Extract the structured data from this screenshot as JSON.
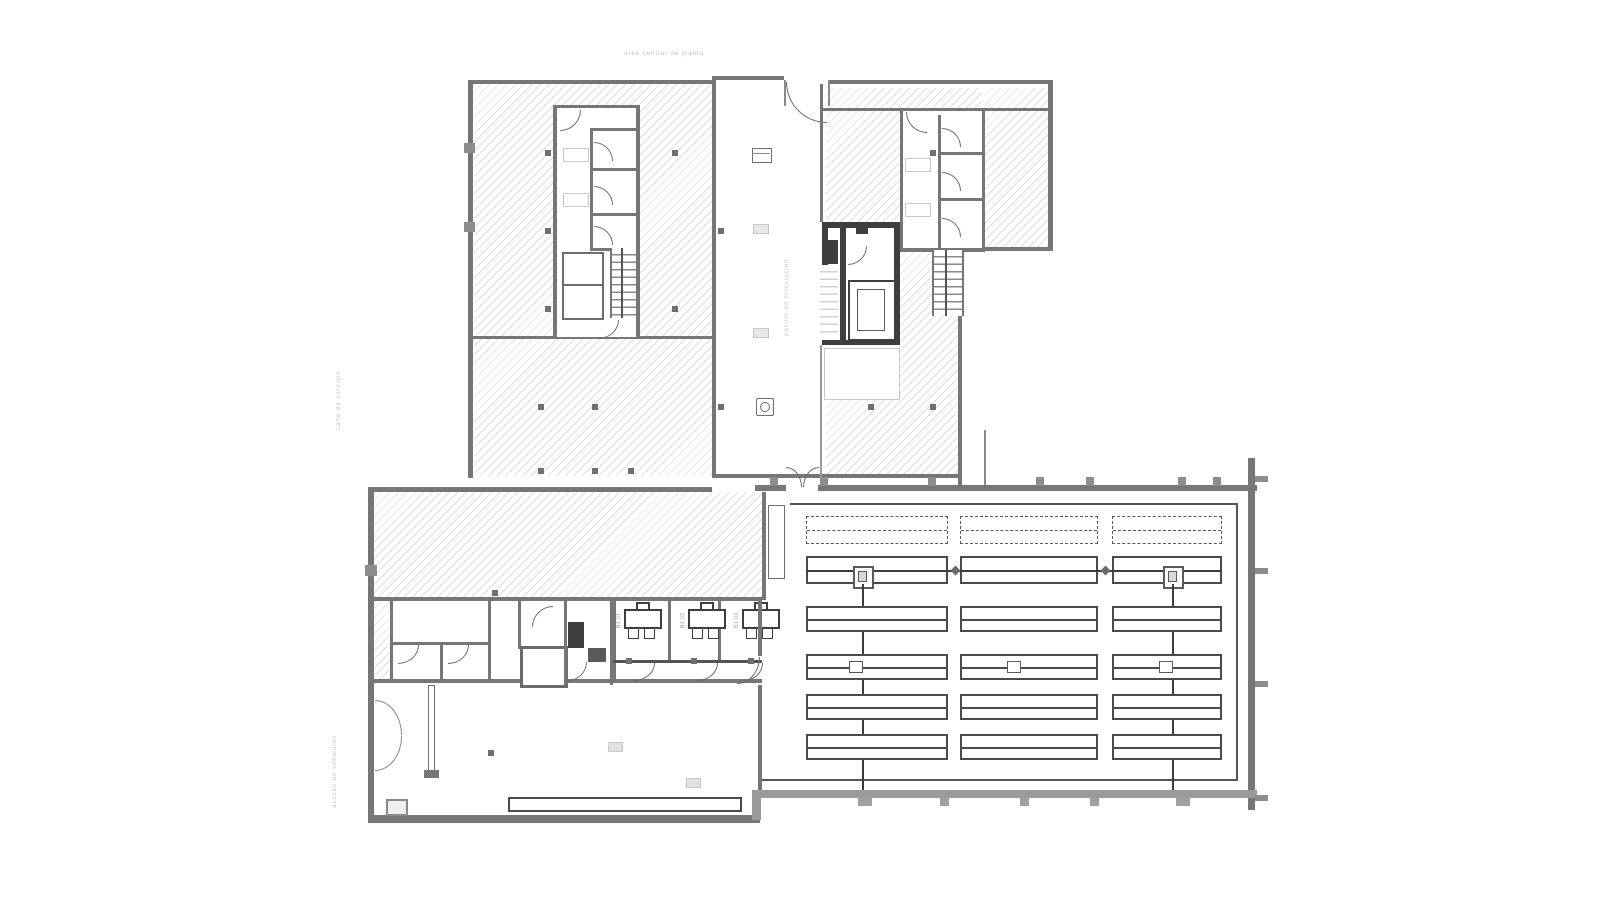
{
  "document": {
    "type": "architectural floor plan",
    "background": "#ffffff",
    "wall_color": "#767676",
    "dark_fill": "#3e3e3e",
    "hatch_color": "#dedede",
    "rack_color": "#4b4b4b",
    "faint_text_color": "#c2c2c2"
  },
  "labels": {
    "top_center": "area central de planta",
    "left_upper_vertical": "calle de servicio",
    "left_lower_vertical": "acceso de vehiculos",
    "corridor_vertical": "pasillo de circulacion"
  },
  "offices": {
    "desks_x": [
      620,
      684,
      738
    ],
    "desk_labels": [
      "B1 01",
      "B1 02",
      "B1 03"
    ]
  },
  "layout": {
    "rack_columns": [
      {
        "x": 806,
        "w": 142
      },
      {
        "x": 960,
        "w": 138
      },
      {
        "x": 1112,
        "w": 110
      }
    ],
    "rack_rows": [
      {
        "y": 516,
        "h": 28,
        "style": "dashed"
      },
      {
        "y": 556,
        "h": 28,
        "style": "conveyor"
      },
      {
        "y": 606,
        "h": 26,
        "style": "solid"
      },
      {
        "y": 654,
        "h": 26,
        "style": "solid",
        "mid_marks": true
      },
      {
        "y": 694,
        "h": 26,
        "style": "solid"
      },
      {
        "y": 734,
        "h": 26,
        "style": "solid"
      }
    ],
    "crane_lines_x": [
      862,
      1172
    ],
    "mid_marks_x": [
      856,
      1014,
      1166
    ],
    "warehouse_top_ticks_x": [
      770,
      820,
      928,
      1036,
      1086,
      1178,
      1213
    ],
    "warehouse_bottom_ticks_x": [
      858,
      940,
      1020,
      1090,
      1176
    ],
    "warehouse_right_ticks_y": [
      476,
      568,
      681,
      795
    ],
    "column_dots": [
      [
        545,
        150
      ],
      [
        545,
        228
      ],
      [
        545,
        306
      ],
      [
        538,
        404
      ],
      [
        592,
        404
      ],
      [
        538,
        468
      ],
      [
        592,
        468
      ],
      [
        628,
        468
      ],
      [
        672,
        150
      ],
      [
        672,
        306
      ],
      [
        930,
        150
      ],
      [
        868,
        404
      ],
      [
        930,
        404
      ],
      [
        718,
        228
      ],
      [
        718,
        404
      ],
      [
        492,
        590
      ],
      [
        488,
        750
      ]
    ]
  }
}
